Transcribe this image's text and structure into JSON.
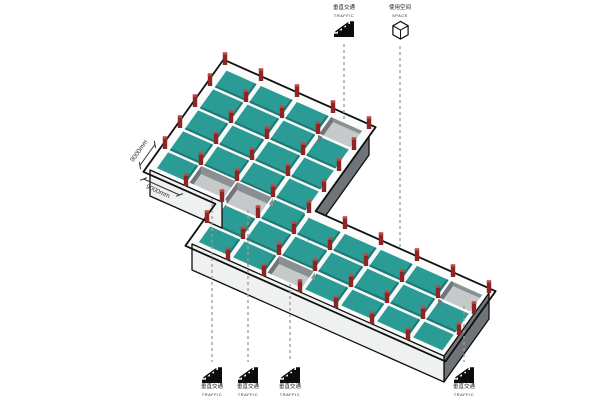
{
  "legend_top": [
    {
      "zh": "垂直交通",
      "en": "TRAFFIC"
    },
    {
      "zh": "使用空间",
      "en": "SPACE"
    }
  ],
  "legend_bottom": [
    {
      "zh": "垂直交通",
      "en": "TRAFFIC"
    },
    {
      "zh": "垂直交通",
      "en": "TRAFFIC"
    },
    {
      "zh": "垂直交通",
      "en": "TRAFFIC"
    },
    {
      "zh": "垂直交通",
      "en": "TRAFFIC"
    }
  ],
  "dimensions": {
    "nw": "9000mm",
    "sw": "9000mm"
  },
  "plan": {
    "grid_module_mm": 9000,
    "wings": [
      {
        "name": "north-wing",
        "u": [
          0,
          4
        ],
        "v": [
          2,
          7
        ]
      },
      {
        "name": "east-wing",
        "u": [
          2,
          9
        ],
        "v": [
          0,
          3
        ]
      }
    ],
    "outline": [
      [
        0,
        2
      ],
      [
        0,
        7
      ],
      [
        4,
        7
      ],
      [
        4,
        3
      ],
      [
        9,
        3
      ],
      [
        9,
        0
      ],
      [
        2,
        0
      ],
      [
        2,
        2
      ]
    ],
    "stairwells": [
      {
        "id": "A",
        "cell": [
          3,
          6
        ],
        "callout": "top"
      },
      {
        "id": "B",
        "cell": [
          1,
          2
        ],
        "callout": "bottom"
      },
      {
        "id": "C",
        "cell": [
          2,
          2
        ],
        "callout": "bottom"
      },
      {
        "id": "D",
        "cell": [
          4,
          0
        ],
        "callout": "bottom"
      },
      {
        "id": "E",
        "cell": [
          8,
          2
        ],
        "callout": "bottom"
      }
    ],
    "walls_dark": [
      {
        "a": [
          4,
          7
        ],
        "b": [
          4,
          3
        ]
      },
      {
        "a": [
          9,
          3
        ],
        "b": [
          9,
          0
        ]
      }
    ],
    "walls_light": [
      {
        "a": [
          9,
          0
        ],
        "b": [
          2,
          0
        ]
      },
      {
        "a": [
          2,
          2
        ],
        "b": [
          0,
          2
        ]
      }
    ]
  },
  "colors": {
    "roof": "#2B9C95",
    "roof_shadow": "#15716B",
    "slab_base": "#F7F8F8",
    "column": "#8E2424",
    "column_cap": "#C14B43",
    "wall_dark": "#6E7478",
    "wall_light": "#EFF1F1",
    "pit_floor": "#C6C9C9",
    "pit_wall_nw": "#70767A",
    "pit_wall_ne": "#8A9092",
    "parapet": "#FAFBFB",
    "outline": "#101010",
    "leader": "#9B9B9B",
    "dim_text": "#333333"
  }
}
